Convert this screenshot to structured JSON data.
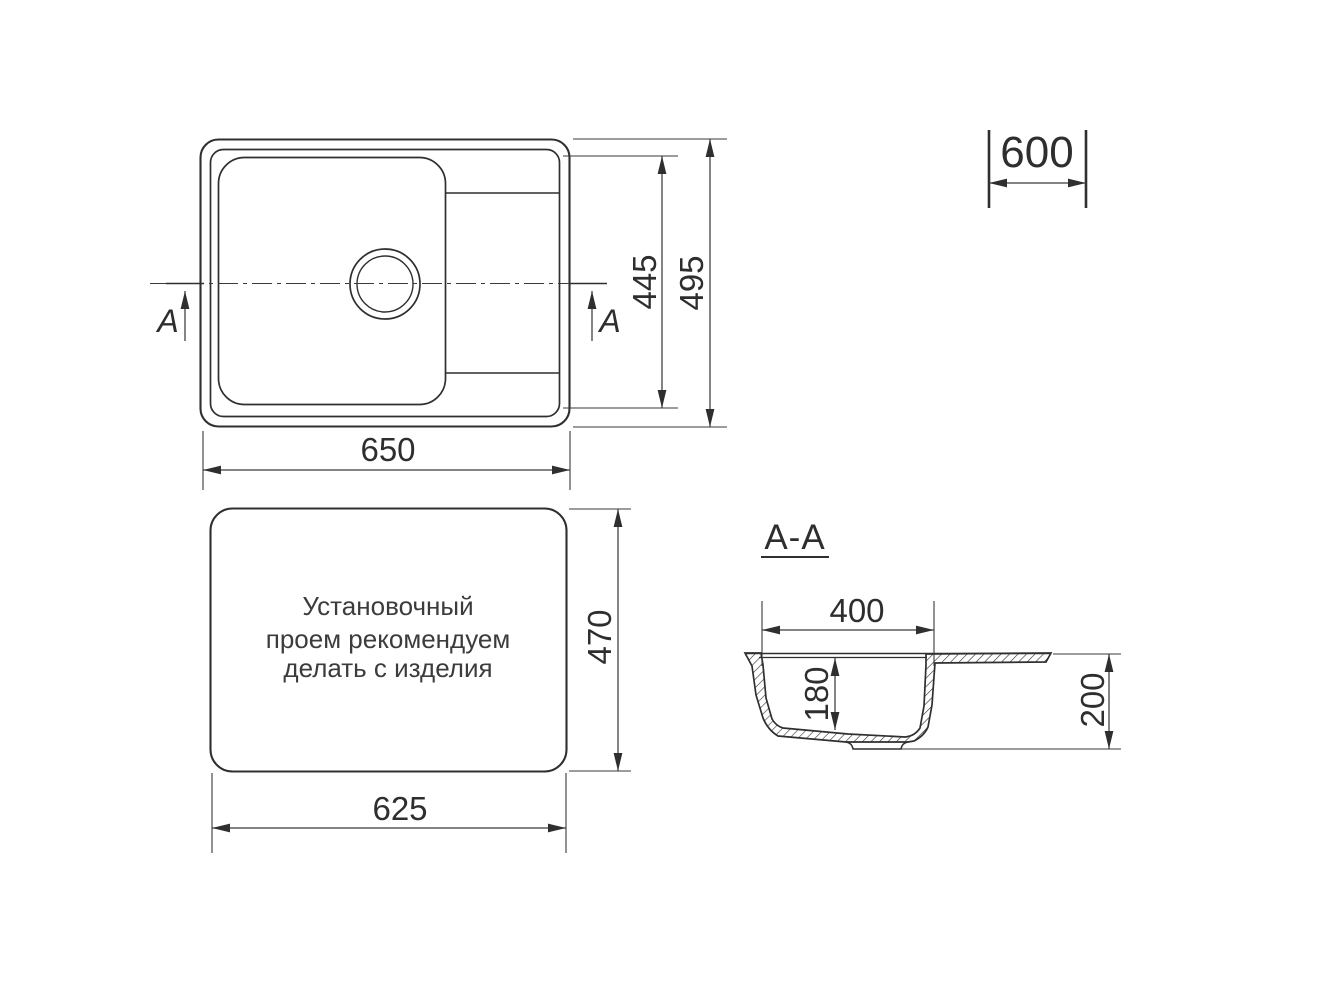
{
  "colors": {
    "background": "#ffffff",
    "line": "#2f2f2f",
    "dimension_line": "#3a3a3a",
    "text": "#2e2e2e",
    "note_text": "#3c3c3c"
  },
  "top_view": {
    "width_label": "650",
    "inner_length_label": "445",
    "outer_length_label": "495",
    "cabinet_width_label": "600",
    "section_mark_left": "A",
    "section_mark_right": "A"
  },
  "installation_view": {
    "note_lines": [
      "Установочный",
      "проем рекомендуем",
      "делать с изделия"
    ],
    "width_label": "625",
    "height_label": "470"
  },
  "section_view": {
    "title": "A-A",
    "bowl_width_label": "400",
    "bowl_depth_label": "180",
    "overall_height_label": "200"
  }
}
